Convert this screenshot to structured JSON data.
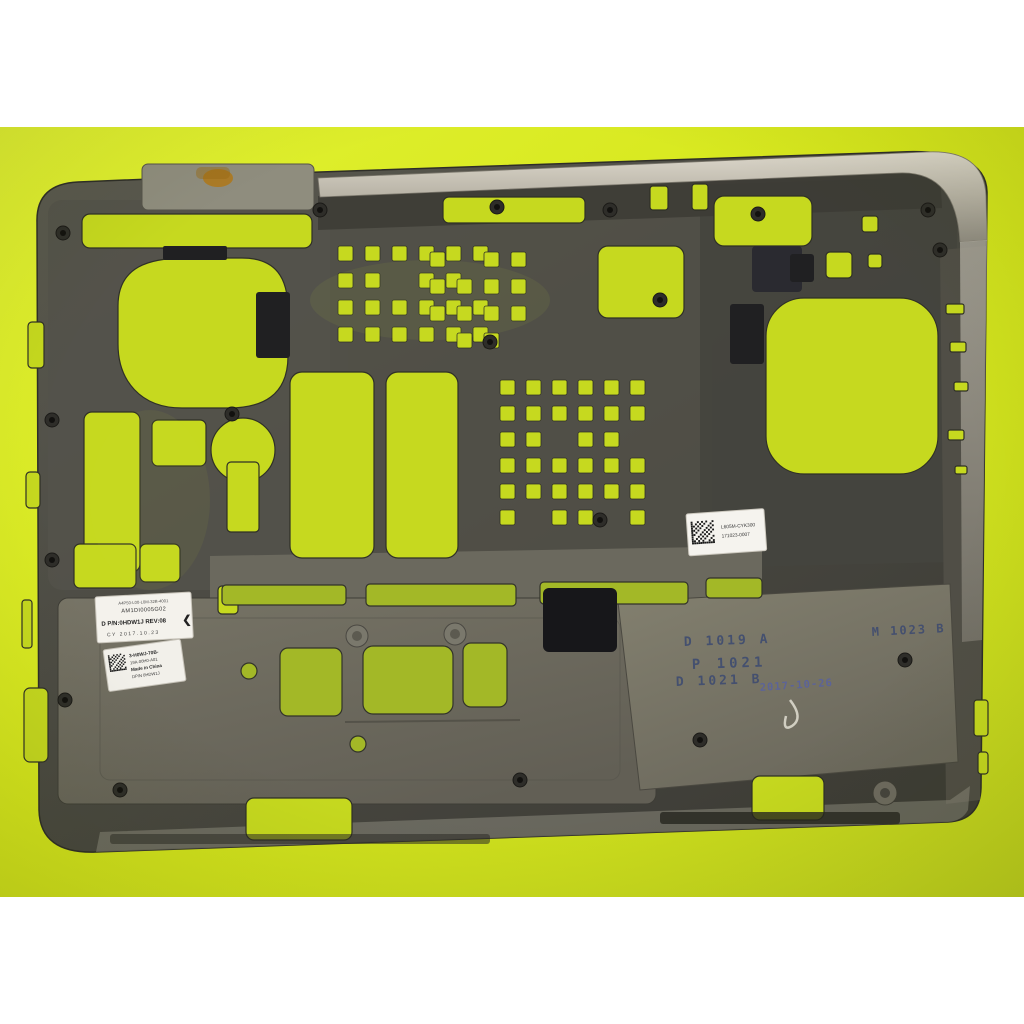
{
  "colors": {
    "background_white": "#ffffff",
    "backdrop_yellow": "#d6e71c",
    "chassis_gray": "#504e46",
    "silver_edge": "#c4bfb2",
    "panel_gray": "#6f6c60",
    "black_pad": "#1c1c1e",
    "sticker_white": "#f4f2ec",
    "stamp_ink_blue": "#3f4c70",
    "date_ink_blue": "#5560a8",
    "rust_stain": "#b07818"
  },
  "stickers": {
    "part_label": {
      "line1": "A4P50-L00-L0M-32B-4001",
      "line2": "AM1DI0005G02",
      "line3": "D P/N:0HDW1J  REV:08",
      "rev_arrow": "❮",
      "line4": "CY  2017.10.23"
    },
    "mfg_label": {
      "line1": "3-H0WJ-70B-",
      "line2": "19A-00H0-A01",
      "line3": "Made in China",
      "line4": "DP/N 0HDW1J"
    },
    "serial_label": {
      "line1": "L605M-CYK300",
      "line2": "171023-0007"
    }
  },
  "stamps": {
    "mold1": "D 1019 A",
    "mold2": "P 1021",
    "mold3": "D 1021 B",
    "mold4": "M 1023 B",
    "date": "2017-10-26"
  }
}
